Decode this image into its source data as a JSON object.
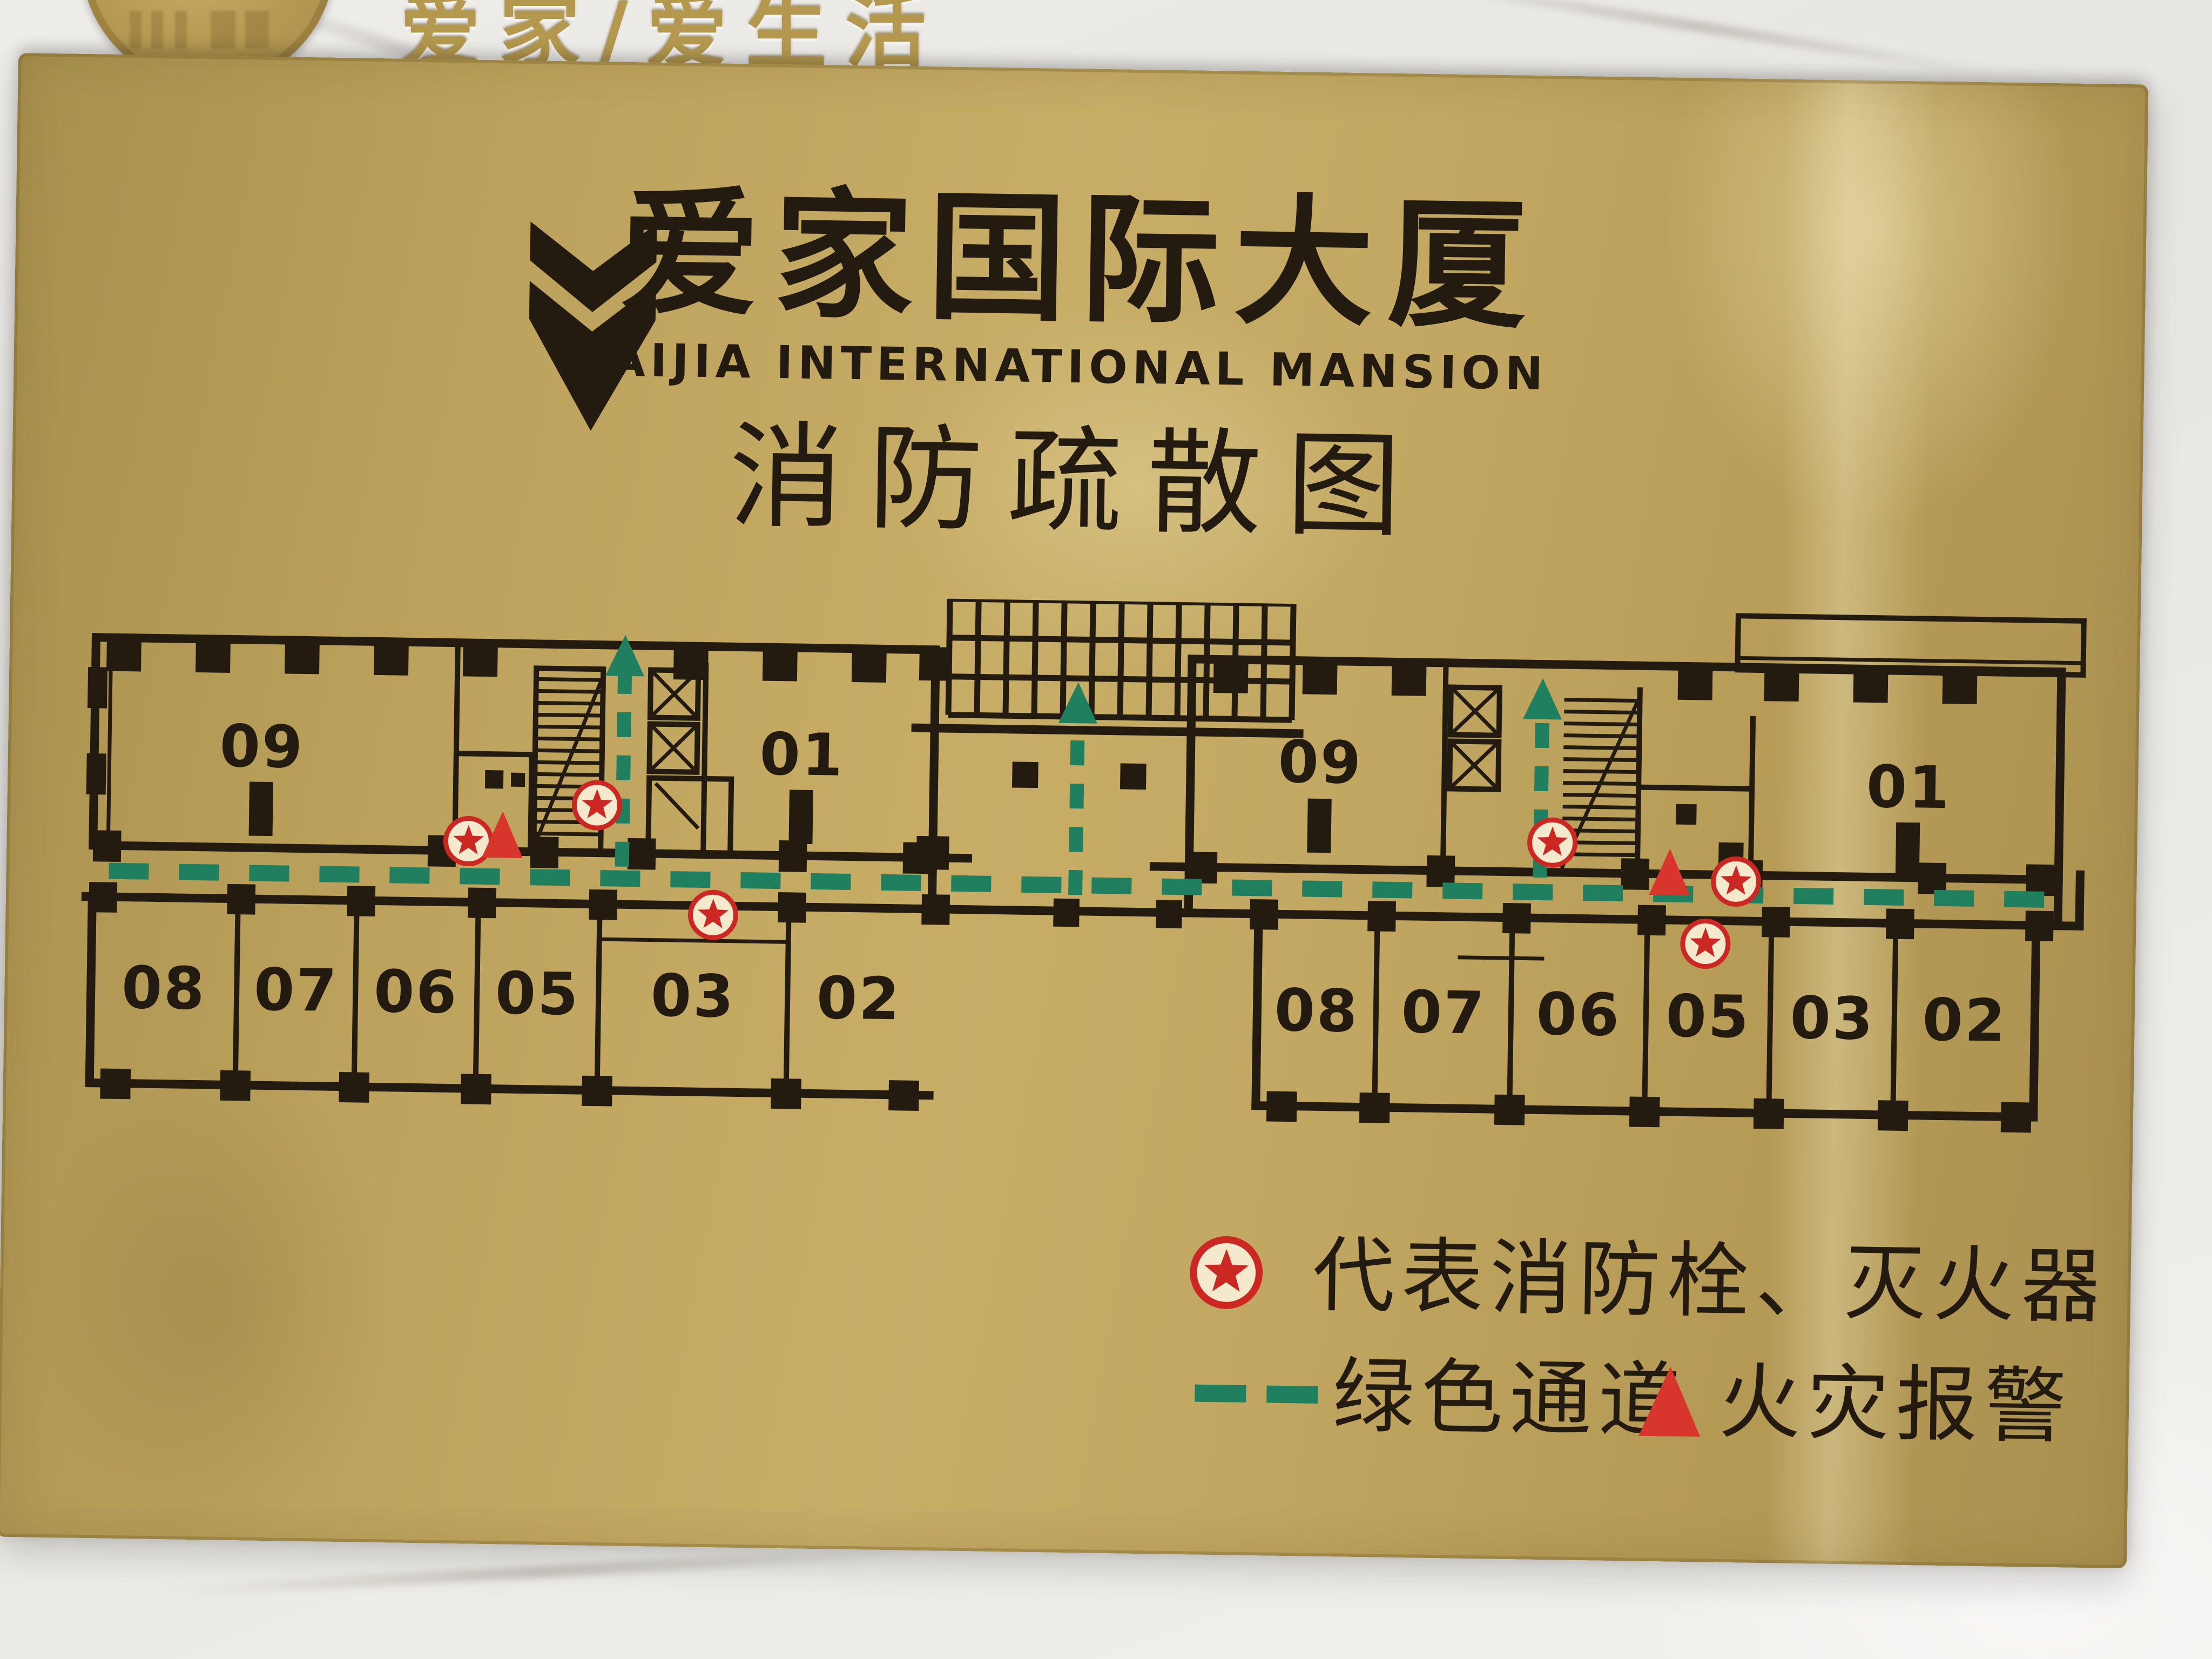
{
  "wall": {
    "brand_text": "爱家/爱生活"
  },
  "plaque": {
    "title_cn": "爱家国际大厦",
    "title_en": "AIJIA INTERNATIONAL MANSION",
    "map_title": "消防疏散图"
  },
  "plan": {
    "left_wing": {
      "top_rooms": [
        "09",
        "01"
      ],
      "bottom_rooms": [
        "08",
        "07",
        "06",
        "05",
        "03",
        "02"
      ]
    },
    "right_wing": {
      "top_rooms": [
        "09",
        "01"
      ],
      "bottom_rooms": [
        "08",
        "07",
        "06",
        "05",
        "03",
        "02"
      ]
    },
    "symbols": {
      "fire_hydrant_count": 6,
      "fire_alarm_count": 2,
      "evacuation_arrow_count": 3
    }
  },
  "legend": {
    "items": [
      {
        "icon": "fire-hydrant-star",
        "label": "代表消防栓、灭火器"
      },
      {
        "icon": "green-route-dash",
        "label": "绿色通道"
      },
      {
        "icon": "fire-alarm-triangle",
        "label": "火灾报警"
      }
    ]
  },
  "colors": {
    "plaque_gold": "#bda25d",
    "ink": "#241b10",
    "route_green": "#1f7f5e",
    "alarm_red": "#d02b24",
    "marble": "#e9e7e3"
  }
}
